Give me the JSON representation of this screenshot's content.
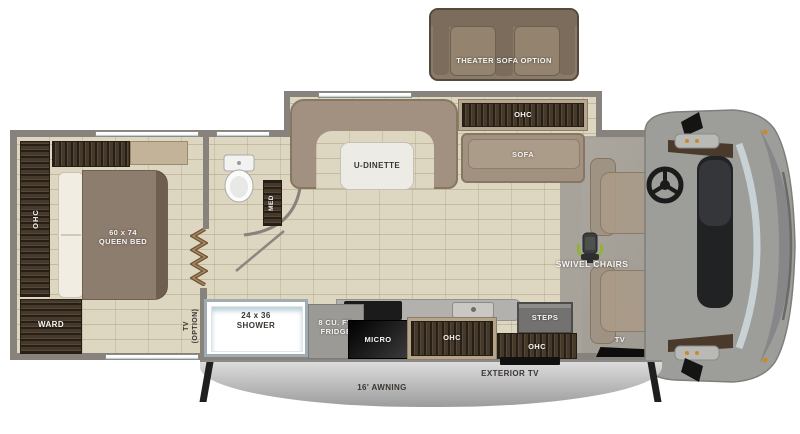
{
  "areas": {
    "options": {
      "theater_sofa": "THEATER SOFA OPTION"
    },
    "bedroom": {
      "ohc": "OHC",
      "ward": "WARD",
      "bed_size": "60 x 74",
      "bed_type": "QUEEN BED",
      "tv": "TV",
      "tv_option": "(OPTION)"
    },
    "bath": {
      "med": "MED"
    },
    "dinette": {
      "label": "U-DINETTE"
    },
    "lounge": {
      "ohc": "OHC",
      "sofa": "SOFA"
    },
    "kitchen": {
      "shower_size": "24 x 36",
      "shower": "SHOWER",
      "fridge_size": "8 CU. FT.",
      "fridge": "FRIDGE",
      "micro": "MICRO",
      "ohc": "OHC"
    },
    "entry": {
      "steps": "STEPS",
      "ohc": "OHC"
    },
    "cab": {
      "swivel_chairs": "SWIVEL CHAIRS",
      "bunk_line1": "CAB-OVER",
      "bunk_line2": "BUNK",
      "tv": "TV"
    },
    "exterior": {
      "tv": "EXTERIOR TV",
      "awning": "16' AWNING"
    }
  },
  "colors": {
    "wall": "#87837c",
    "floor": "#ddd6c1",
    "wood": "#46392a",
    "taupe": "#a29181",
    "mattress": "#8d7d6f",
    "pillow": "#f1ede3",
    "fridge_gray": "#9c9a97",
    "counter_gray": "#b3b1ad",
    "micro_black": "#161616",
    "steps_gray": "#747270",
    "cab_gray": "#a7a29a",
    "body_gray": "#9d9d9a",
    "glass": "#212224",
    "windshield": "#ccd7da",
    "accent_green": "#93b13f",
    "awning_light": "#dcdcdc",
    "awning_dark": "#9c9c9c",
    "label_light": "#f7f5f1",
    "label_dark": "#3a3531"
  }
}
